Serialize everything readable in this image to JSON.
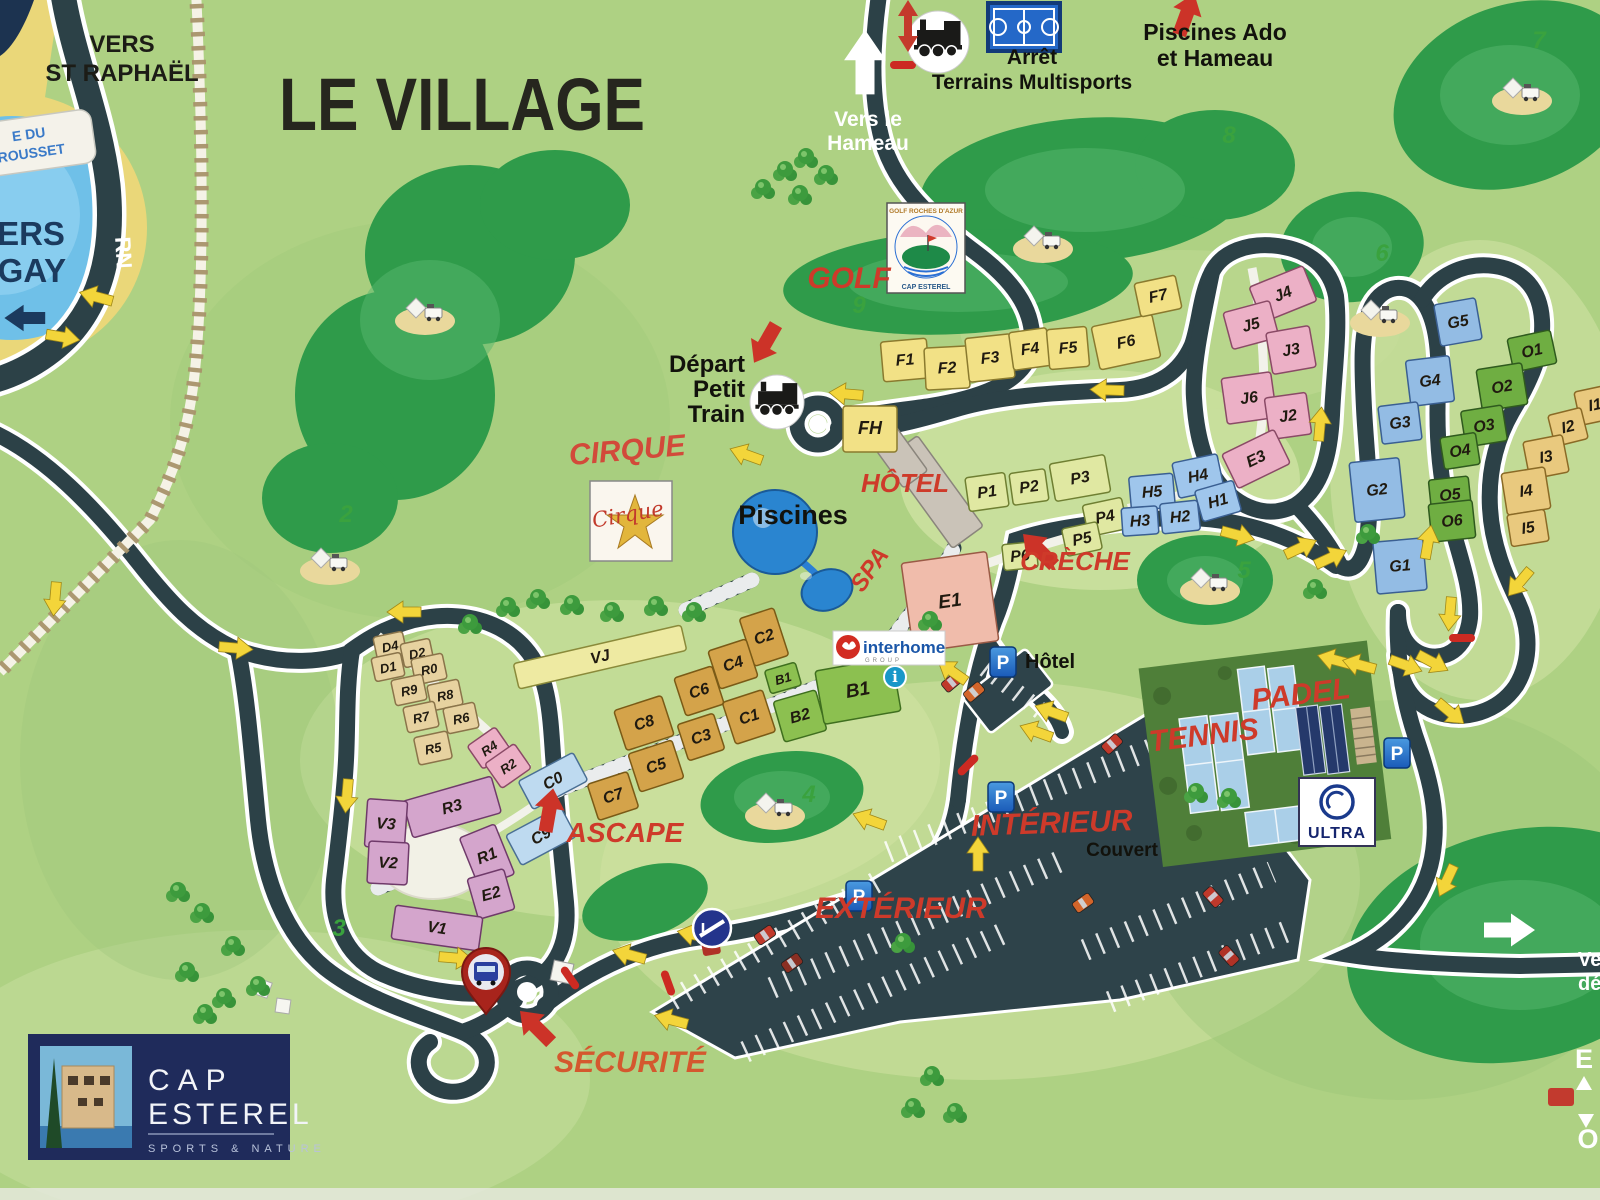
{
  "title": "LE VILLAGE",
  "colors": {
    "bg": "#aed183",
    "road": "#2c4147",
    "casing": "#ffffff",
    "darkgreen": "#2f9b4a",
    "red_label": "#ce3a2a",
    "securite": "#d4582e",
    "yellow_arrow": "#f3d53a",
    "water": "#6fc0e8",
    "sand": "#ead779",
    "navy": "#1b3a5e",
    "parking": "#2e434a"
  },
  "building_groups": {
    "F": {
      "fill": "#f2e186",
      "stroke": "#8a7a2e"
    },
    "VJ": {
      "fill": "#eeeaa2",
      "stroke": "#8a8a3a"
    },
    "P": {
      "fill": "#e0e8a2",
      "stroke": "#6f7f32"
    },
    "J": {
      "fill": "#ecb0c6",
      "stroke": "#8a4a66"
    },
    "H": {
      "fill": "#9fc6ec",
      "stroke": "#3a5f92"
    },
    "G": {
      "fill": "#93bce4",
      "stroke": "#3a5f92"
    },
    "O": {
      "fill": "#6fae42",
      "stroke": "#2f5a1e"
    },
    "I": {
      "fill": "#e9c97e",
      "stroke": "#8a6a26"
    },
    "D": {
      "fill": "#e7d2a0",
      "stroke": "#8a744a"
    },
    "V": {
      "fill": "#d4a5cc",
      "stroke": "#6f3a6a"
    },
    "CB": {
      "fill": "#bedaf0",
      "stroke": "#4a6f94"
    },
    "C": {
      "fill": "#d4a34a",
      "stroke": "#7a5a16"
    },
    "B": {
      "fill": "#8cc050",
      "stroke": "#3f6f1f"
    },
    "E1": {
      "fill": "#f0bcab",
      "stroke": "#9a5a46"
    }
  },
  "buildings": [
    [
      "F1",
      905,
      360,
      46,
      40,
      -5,
      "F"
    ],
    [
      "F2",
      947,
      368,
      44,
      42,
      -3,
      "F"
    ],
    [
      "F3",
      990,
      358,
      46,
      44,
      -6,
      "F"
    ],
    [
      "F4",
      1030,
      349,
      38,
      38,
      -8,
      "F"
    ],
    [
      "F5",
      1068,
      348,
      40,
      40,
      -5,
      "F"
    ],
    [
      "F6",
      1126,
      342,
      62,
      44,
      -12,
      "F"
    ],
    [
      "F7",
      1158,
      296,
      42,
      34,
      -12,
      "F"
    ],
    [
      "FH",
      870,
      429,
      54,
      46,
      0,
      "F",
      18
    ],
    [
      "VJ",
      600,
      657,
      172,
      26,
      -13,
      "VJ"
    ],
    [
      "P1",
      987,
      492,
      40,
      34,
      -8,
      "P"
    ],
    [
      "P2",
      1029,
      487,
      36,
      32,
      -8,
      "P"
    ],
    [
      "P3",
      1080,
      478,
      56,
      38,
      -10,
      "P"
    ],
    [
      "P4",
      1105,
      517,
      40,
      32,
      -12,
      "P"
    ],
    [
      "P5",
      1082,
      539,
      36,
      28,
      -12,
      "P"
    ],
    [
      "P6",
      1020,
      556,
      34,
      26,
      -6,
      "P"
    ],
    [
      "J4",
      1283,
      294,
      58,
      38,
      -22,
      "J"
    ],
    [
      "J5",
      1251,
      325,
      48,
      38,
      -15,
      "J"
    ],
    [
      "J3",
      1291,
      350,
      44,
      42,
      -10,
      "J"
    ],
    [
      "J6",
      1249,
      398,
      50,
      46,
      -8,
      "J"
    ],
    [
      "J2",
      1288,
      416,
      42,
      42,
      -8,
      "J"
    ],
    [
      "E3",
      1256,
      459,
      58,
      38,
      -26,
      "J"
    ],
    [
      "H5",
      1152,
      492,
      44,
      34,
      -5,
      "H"
    ],
    [
      "H4",
      1198,
      476,
      46,
      36,
      -12,
      "H"
    ],
    [
      "H3",
      1140,
      521,
      36,
      28,
      -4,
      "H"
    ],
    [
      "H2",
      1180,
      517,
      38,
      30,
      -6,
      "H"
    ],
    [
      "H1",
      1218,
      501,
      40,
      32,
      -16,
      "H"
    ],
    [
      "G5",
      1458,
      322,
      42,
      42,
      -10,
      "G"
    ],
    [
      "G4",
      1430,
      381,
      44,
      46,
      -7,
      "G"
    ],
    [
      "G3",
      1400,
      423,
      40,
      38,
      -7,
      "G"
    ],
    [
      "G2",
      1377,
      490,
      50,
      60,
      -6,
      "G"
    ],
    [
      "G1",
      1400,
      566,
      50,
      52,
      -5,
      "G"
    ],
    [
      "O1",
      1532,
      351,
      44,
      34,
      -12,
      "O"
    ],
    [
      "O2",
      1502,
      387,
      46,
      42,
      -9,
      "O"
    ],
    [
      "O3",
      1484,
      426,
      42,
      36,
      -9,
      "O"
    ],
    [
      "O4",
      1460,
      451,
      36,
      32,
      -9,
      "O"
    ],
    [
      "O5",
      1450,
      495,
      40,
      34,
      -6,
      "O"
    ],
    [
      "O6",
      1452,
      521,
      44,
      38,
      -6,
      "O"
    ],
    [
      "I1",
      1595,
      405,
      36,
      34,
      -12,
      "I"
    ],
    [
      "I2",
      1568,
      427,
      34,
      32,
      -14,
      "I"
    ],
    [
      "I3",
      1546,
      457,
      40,
      38,
      -11,
      "I"
    ],
    [
      "I4",
      1526,
      491,
      44,
      42,
      -9,
      "I"
    ],
    [
      "I5",
      1528,
      528,
      38,
      32,
      -9,
      "I"
    ],
    [
      "D4",
      390,
      646,
      30,
      24,
      -12,
      "D",
      13
    ],
    [
      "D2",
      417,
      653,
      30,
      24,
      -12,
      "D",
      13
    ],
    [
      "D1",
      388,
      667,
      30,
      24,
      -12,
      "D",
      13
    ],
    [
      "R0",
      429,
      669,
      32,
      26,
      -12,
      "D",
      13
    ],
    [
      "R9",
      409,
      690,
      32,
      26,
      -12,
      "D",
      13
    ],
    [
      "R8",
      445,
      695,
      32,
      26,
      -12,
      "D",
      13
    ],
    [
      "R7",
      421,
      717,
      32,
      26,
      -12,
      "D",
      13
    ],
    [
      "R6",
      461,
      718,
      32,
      26,
      -12,
      "D",
      13
    ],
    [
      "R5",
      433,
      748,
      34,
      28,
      -12,
      "D",
      13
    ],
    [
      "R4",
      489,
      748,
      34,
      28,
      -35,
      "J",
      13
    ],
    [
      "R2",
      508,
      766,
      36,
      30,
      -35,
      "J",
      13
    ],
    [
      "R3",
      452,
      807,
      92,
      38,
      -16,
      "V"
    ],
    [
      "V3",
      386,
      824,
      40,
      48,
      4,
      "V"
    ],
    [
      "V2",
      388,
      863,
      40,
      42,
      3,
      "V"
    ],
    [
      "R1",
      487,
      856,
      38,
      54,
      -22,
      "V"
    ],
    [
      "E2",
      491,
      894,
      38,
      42,
      -16,
      "V"
    ],
    [
      "V1",
      437,
      928,
      88,
      34,
      8,
      "V"
    ],
    [
      "C0",
      553,
      781,
      62,
      32,
      -28,
      "CB"
    ],
    [
      "C9",
      541,
      836,
      62,
      34,
      -28,
      "CB"
    ],
    [
      "C2",
      764,
      637,
      36,
      50,
      -18,
      "C"
    ],
    [
      "C4",
      733,
      664,
      40,
      40,
      -18,
      "C"
    ],
    [
      "C6",
      699,
      691,
      40,
      40,
      -18,
      "C"
    ],
    [
      "C8",
      644,
      723,
      50,
      42,
      -18,
      "C"
    ],
    [
      "C1",
      749,
      717,
      42,
      44,
      -18,
      "C"
    ],
    [
      "C3",
      701,
      737,
      38,
      38,
      -18,
      "C"
    ],
    [
      "C5",
      656,
      766,
      46,
      40,
      -18,
      "C"
    ],
    [
      "C7",
      613,
      796,
      42,
      38,
      -18,
      "C"
    ],
    [
      "B1",
      783,
      678,
      32,
      24,
      -16,
      "B",
      13
    ],
    [
      "B2",
      800,
      716,
      44,
      42,
      -16,
      "B"
    ],
    [
      "B1",
      858,
      691,
      78,
      54,
      -10,
      "B",
      19
    ],
    [
      "E1",
      950,
      602,
      86,
      90,
      -8,
      "E1",
      19
    ]
  ],
  "labels": [
    {
      "n": "vers-st-raphael",
      "t": "VERS\nST RAPHAËL",
      "x": 122,
      "y": 52,
      "s": 24,
      "c": "#1c1c16",
      "lh": 29
    },
    {
      "n": "map-title",
      "t": "LE VILLAGE",
      "x": 462,
      "y": 130,
      "s": 74,
      "c": "#26261e",
      "sx": 0.84
    },
    {
      "n": "vers-le-hameau",
      "t": "Vers le\nHameau",
      "x": 868,
      "y": 126,
      "s": 21,
      "c": "#ffffff",
      "lh": 24
    },
    {
      "n": "arret-terrains",
      "t": "Arrêt\nTerrains Multisports",
      "x": 1032,
      "y": 64,
      "s": 21,
      "c": "#12120c",
      "lh": 25
    },
    {
      "n": "piscines-ado",
      "t": "Piscines Ado\net Hameau",
      "x": 1215,
      "y": 40,
      "s": 23,
      "c": "#12120c",
      "lh": 26
    },
    {
      "n": "depart-petit-train",
      "t": "Départ\nPetit\nTrain",
      "x": 745,
      "y": 372,
      "s": 24,
      "c": "#12120c",
      "lh": 25,
      "a": "end"
    },
    {
      "n": "golf-label",
      "t": "GOLF",
      "x": 849,
      "y": 288,
      "s": 30,
      "c": "#ce3a2a",
      "i": 1
    },
    {
      "n": "cirque-label",
      "t": "CIRQUE",
      "x": 628,
      "y": 460,
      "s": 30,
      "c": "#d24a3a",
      "i": 1,
      "r": -5
    },
    {
      "n": "hotel-label-red",
      "t": "HÔTEL",
      "x": 905,
      "y": 492,
      "s": 26,
      "c": "#ce3a2a",
      "i": 1
    },
    {
      "n": "spa-label",
      "t": "SPA",
      "x": 876,
      "y": 574,
      "s": 24,
      "c": "#ce3a2a",
      "i": 1,
      "r": -55
    },
    {
      "n": "creche-label",
      "t": "CRÈCHE",
      "x": 1075,
      "y": 570,
      "s": 26,
      "c": "#ce3a2a",
      "i": 1
    },
    {
      "n": "ascape-label",
      "t": "ASCAPE",
      "x": 625,
      "y": 842,
      "s": 28,
      "c": "#ce3a2a",
      "i": 1
    },
    {
      "n": "tennis-label",
      "t": "TENNIS",
      "x": 1205,
      "y": 745,
      "s": 30,
      "c": "#ce3a2a",
      "i": 1,
      "r": -7
    },
    {
      "n": "padel-label",
      "t": "PADEL",
      "x": 1302,
      "y": 704,
      "s": 30,
      "c": "#ce3a2a",
      "i": 1,
      "r": -7
    },
    {
      "n": "interieur-label",
      "t": "INTÉRIEUR",
      "x": 1052,
      "y": 833,
      "s": 30,
      "c": "#ce3a2a",
      "i": 1,
      "r": -2
    },
    {
      "n": "couvert-label",
      "t": "Couvert",
      "x": 1122,
      "y": 856,
      "s": 19,
      "c": "#12120c"
    },
    {
      "n": "exterieur-label",
      "t": "EXTÉRIEUR",
      "x": 901,
      "y": 918,
      "s": 30,
      "c": "#ce3a2a",
      "i": 1
    },
    {
      "n": "securite-label",
      "t": "SÉCURITÉ",
      "x": 630,
      "y": 1072,
      "s": 30,
      "c": "#d4582e",
      "i": 1
    },
    {
      "n": "piscines-label",
      "t": "Piscines",
      "x": 793,
      "y": 524,
      "s": 27,
      "c": "#12120c"
    },
    {
      "n": "p-hotel-label",
      "t": "Hôtel",
      "x": 1050,
      "y": 668,
      "s": 20,
      "c": "#12120c"
    },
    {
      "n": "rn-label",
      "t": "RN",
      "x": 116,
      "y": 253,
      "s": 22,
      "c": "#ffffff",
      "r": 87
    },
    {
      "n": "vers-agay",
      "t": "VERS\nAGAY",
      "x": 20,
      "y": 245,
      "s": 33,
      "c": "#1b3a5e",
      "lh": 37
    },
    {
      "n": "exit-partial-1",
      "t": "Ve",
      "x": 1578,
      "y": 966,
      "s": 20,
      "c": "#ffffff",
      "a": "start"
    },
    {
      "n": "exit-partial-2",
      "t": "dé",
      "x": 1578,
      "y": 990,
      "s": 20,
      "c": "#ffffff",
      "a": "start"
    },
    {
      "n": "legend-partial-e",
      "t": "E",
      "x": 1584,
      "y": 1068,
      "s": 27,
      "c": "#ffffff"
    },
    {
      "n": "legend-partial-o",
      "t": "O",
      "x": 1588,
      "y": 1148,
      "s": 27,
      "c": "#ffffff"
    }
  ],
  "hole_numbers": [
    [
      "2",
      346,
      522
    ],
    [
      "3",
      339,
      936
    ],
    [
      "4",
      809,
      802
    ],
    [
      "5",
      1244,
      578
    ],
    [
      "6",
      1382,
      261
    ],
    [
      "7",
      1539,
      48
    ],
    [
      "8",
      1229,
      143
    ],
    [
      "9",
      859,
      313
    ]
  ],
  "arrows_yellow": [
    [
      62,
      337,
      10
    ],
    [
      97,
      297,
      195
    ],
    [
      405,
      612,
      180
    ],
    [
      347,
      795,
      95
    ],
    [
      455,
      958,
      5
    ],
    [
      630,
      955,
      195
    ],
    [
      695,
      935,
      192
    ],
    [
      672,
      1020,
      195
    ],
    [
      747,
      455,
      200
    ],
    [
      847,
      394,
      185
    ],
    [
      1108,
      390,
      182
    ],
    [
      1320,
      425,
      -85
    ],
    [
      1237,
      535,
      15
    ],
    [
      1300,
      548,
      -25
    ],
    [
      1330,
      558,
      -25
    ],
    [
      1428,
      543,
      -80
    ],
    [
      1450,
      613,
      95
    ],
    [
      1520,
      582,
      130
    ],
    [
      953,
      672,
      215
    ],
    [
      1052,
      712,
      200
    ],
    [
      1037,
      732,
      200
    ],
    [
      978,
      855,
      -90
    ],
    [
      870,
      820,
      200
    ],
    [
      1447,
      880,
      115
    ],
    [
      1335,
      660,
      -165
    ],
    [
      1360,
      665,
      -165
    ],
    [
      1405,
      665,
      20
    ],
    [
      1432,
      662,
      28
    ],
    [
      1450,
      712,
      40
    ],
    [
      55,
      598,
      95
    ],
    [
      235,
      648,
      5
    ]
  ],
  "arrows_red": [
    [
      1186,
      16,
      -70
    ],
    [
      1040,
      551,
      -135
    ],
    [
      549,
      812,
      -80
    ],
    [
      537,
      1028,
      -135
    ],
    [
      766,
      342,
      120
    ]
  ],
  "dashes_red": [
    [
      903,
      65,
      0
    ],
    [
      570,
      978,
      55
    ],
    [
      668,
      983,
      70
    ],
    [
      968,
      765,
      -45
    ],
    [
      1462,
      638,
      0
    ]
  ],
  "arrows_white": [
    [
      865,
      64,
      -90,
      1.9,
      "#ffffff"
    ],
    [
      1508,
      930,
      0,
      1.5,
      "#ffffff"
    ],
    [
      26,
      318,
      180,
      1.2,
      "#1b3a5e"
    ]
  ],
  "trees": [
    [
      785,
      172
    ],
    [
      806,
      159
    ],
    [
      826,
      176
    ],
    [
      763,
      190
    ],
    [
      800,
      196
    ],
    [
      508,
      608
    ],
    [
      538,
      600
    ],
    [
      572,
      606
    ],
    [
      612,
      613
    ],
    [
      656,
      607
    ],
    [
      694,
      613
    ],
    [
      470,
      625
    ],
    [
      178,
      893
    ],
    [
      202,
      914
    ],
    [
      233,
      947
    ],
    [
      187,
      973
    ],
    [
      258,
      987
    ],
    [
      224,
      999
    ],
    [
      205,
      1015
    ],
    [
      903,
      944
    ],
    [
      932,
      1077
    ],
    [
      955,
      1114
    ],
    [
      913,
      1109
    ],
    [
      1196,
      794
    ],
    [
      1229,
      799
    ],
    [
      930,
      622
    ],
    [
      1368,
      535
    ],
    [
      1315,
      590
    ]
  ],
  "golf_carts": [
    [
      425,
      315
    ],
    [
      330,
      565
    ],
    [
      1043,
      243
    ],
    [
      1522,
      95
    ],
    [
      1380,
      317
    ],
    [
      1210,
      585
    ],
    [
      775,
      810
    ]
  ],
  "cars": [
    [
      952,
      682,
      -40,
      "#c0392b"
    ],
    [
      974,
      692,
      -40,
      "#d3652a"
    ],
    [
      1112,
      744,
      -42,
      "#c0392b"
    ],
    [
      765,
      935,
      -35,
      "#c0392b"
    ],
    [
      792,
      963,
      -35,
      "#8a2f23"
    ],
    [
      1213,
      897,
      48,
      "#c0392b"
    ],
    [
      1229,
      956,
      48,
      "#b03226"
    ],
    [
      1083,
      903,
      -35,
      "#d3652a"
    ]
  ],
  "parking": {
    "letter": "P",
    "icons": [
      [
        1003,
        662
      ],
      [
        1001,
        797
      ],
      [
        859,
        896
      ],
      [
        1397,
        753
      ]
    ]
  },
  "info_icon": {
    "letter": "i",
    "x": 895,
    "y": 677
  },
  "pill": {
    "line1": "E DU",
    "line2": "ROUSSET"
  },
  "logos": {
    "golf": {
      "top": "GOLF ROCHES D'AZUR",
      "bottom": "CAP ESTEREL"
    },
    "cirque": {
      "script": "Cirque"
    },
    "interhome": {
      "brand": "interhome",
      "sub": "GROUP"
    },
    "ultra": {
      "label": "ULTRA"
    },
    "cap": {
      "line1": "CAP",
      "line2": "ESTEREL",
      "tagline": "SPORTS & NATURE"
    }
  }
}
